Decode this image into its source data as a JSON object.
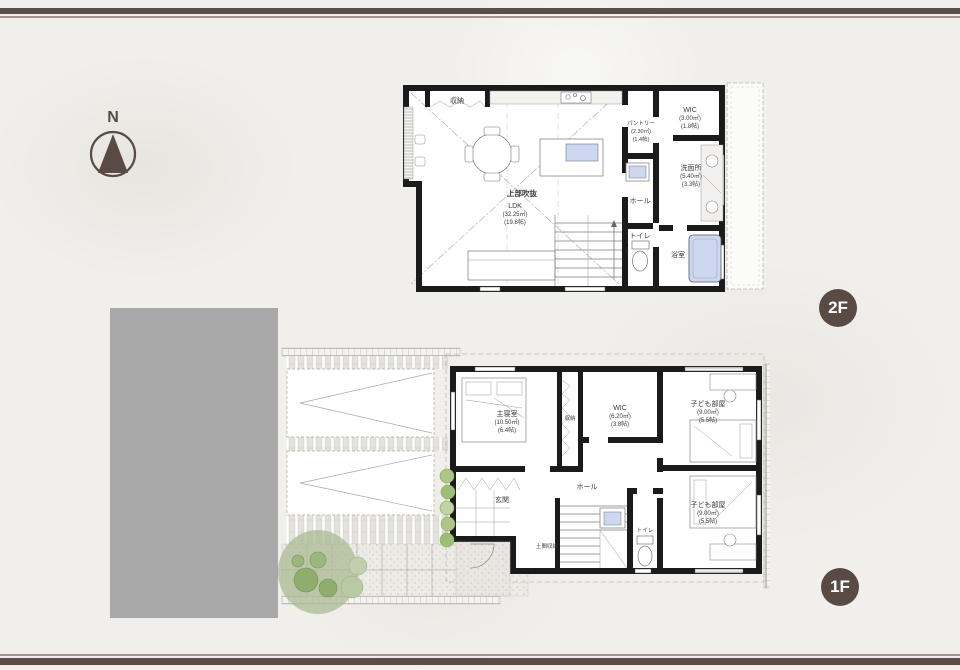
{
  "page": {
    "background": "#f0efeb",
    "accent_brown": "#5a4a44",
    "wall_black": "#1b1b1b",
    "fixture_blue": "#cdd8ee",
    "building_gray": "#a8a8a8",
    "tree_green": "#8fae6d"
  },
  "compass": {
    "label": "N"
  },
  "badges": {
    "floor2": "2F",
    "floor1": "1F"
  },
  "floor2": {
    "closet": "収納",
    "void_label": "上部吹抜",
    "ldk": {
      "name": "LDK",
      "area": "(32.25㎡)",
      "tatami": "(19.8帖)"
    },
    "pantry": {
      "name": "パントリー",
      "area": "(2.30㎡)",
      "tatami": "(1.4帖)"
    },
    "wic": {
      "name": "WIC",
      "area": "(3.00㎡)",
      "tatami": "(1.8帖)"
    },
    "washroom": {
      "name": "洗面所",
      "area": "(5.40㎡)",
      "tatami": "(3.3帖)"
    },
    "hall": "ホール",
    "toilet": "トイレ",
    "bath": "浴室"
  },
  "floor1": {
    "master": {
      "name": "主寝室",
      "area": "(10.50㎡)",
      "tatami": "(6.4帖)"
    },
    "closet": "収納",
    "wic": {
      "name": "WIC",
      "area": "(6.20㎡)",
      "tatami": "(3.8帖)"
    },
    "kids1": {
      "name": "子ども部屋",
      "area": "(9.00㎡)",
      "tatami": "(5.5帖)"
    },
    "kids2": {
      "name": "子ども部屋",
      "area": "(9.00㎡)",
      "tatami": "(5.5帖)"
    },
    "hall": "ホール",
    "entrance": "玄関",
    "doma": "土間収納",
    "toilet": "トイレ"
  }
}
